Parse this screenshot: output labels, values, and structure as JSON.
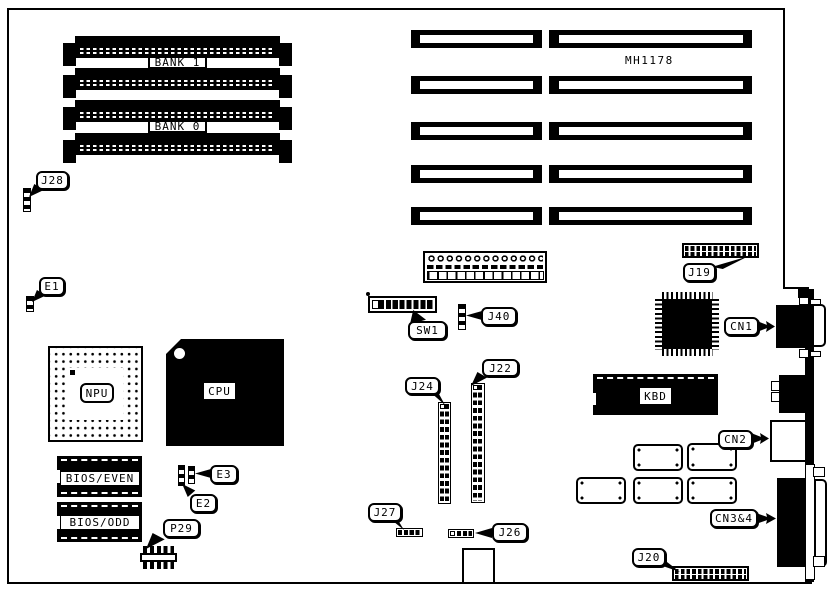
{
  "board": {
    "silkscreen": {
      "model": "MH1178"
    },
    "memory_banks": {
      "bank1": "BANK 1",
      "bank0": "BANK 0"
    },
    "chips": {
      "npu": "NPU",
      "cpu": "CPU",
      "kbd": "KBD",
      "bios_even": "BIOS/EVEN",
      "bios_odd": "BIOS/ODD"
    },
    "callouts": {
      "j28": "J28",
      "e1": "E1",
      "e2": "E2",
      "e3": "E3",
      "p29": "P29",
      "sw1": "SW1",
      "j40": "J40",
      "j24": "J24",
      "j22": "J22",
      "j27": "J27",
      "j26": "J26",
      "j19": "J19",
      "j20": "J20",
      "cn1": "CN1",
      "cn2": "CN2",
      "cn34": "CN3&4"
    },
    "colors": {
      "ink": "#000000",
      "paper": "#ffffff"
    }
  }
}
